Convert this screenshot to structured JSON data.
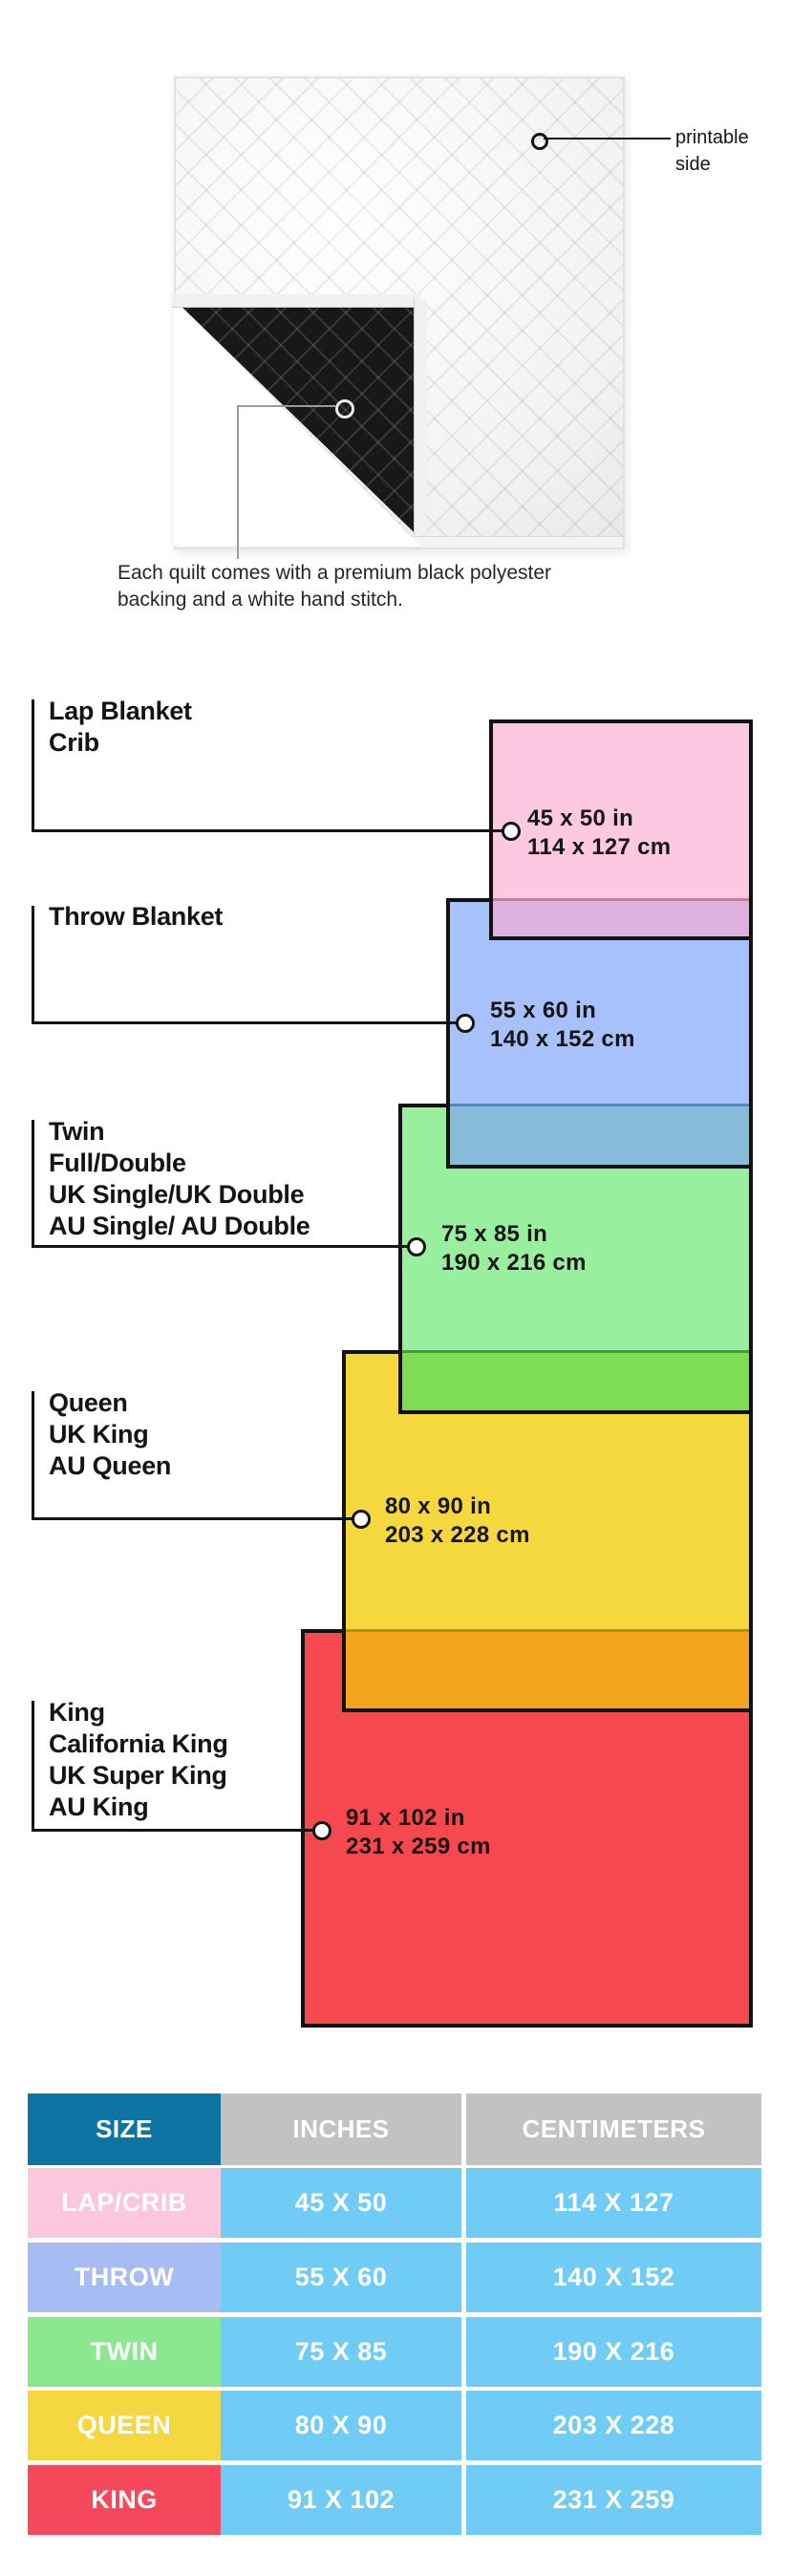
{
  "colors": {
    "page_bg": "#ffffff",
    "outline": "#121212",
    "leader_line": "#141414",
    "header_size_bg": "#0e74a4",
    "header_metric_bg": "#c2c2c2",
    "value_cell_bg": "#70cbf5"
  },
  "quilt": {
    "printable_callout": {
      "line1": "printable",
      "line2": "side"
    },
    "caption": {
      "line1": "Each quilt comes with a premium black polyester",
      "line2": "backing and a white hand stitch."
    }
  },
  "diagram": {
    "sizes": [
      {
        "id": "lap",
        "labels": [
          "Lap Blanket",
          "Crib"
        ],
        "inches": "45 x 50 in",
        "centimeters": "114 x 127 cm",
        "fill": "#fdc9e2",
        "overlap_fill": "#deb2de",
        "overlap_line": "#c2809e"
      },
      {
        "id": "throw",
        "labels": [
          "Throw Blanket"
        ],
        "inches": "55 x 60 in",
        "centimeters": "140 x 152 cm",
        "fill": "#a6c1fb",
        "overlap_fill": "#86bcd9",
        "overlap_line": "#5c84ba"
      },
      {
        "id": "twin",
        "labels": [
          "Twin",
          "Full/Double",
          "UK Single/UK Double",
          "AU Single/ AU Double"
        ],
        "inches": "75 x 85 in",
        "centimeters": "190 x 216 cm",
        "fill": "#98ef9e",
        "overlap_fill": "#7edc55",
        "overlap_line": "#3f9e41"
      },
      {
        "id": "queen",
        "labels": [
          "Queen",
          "UK King",
          "AU Queen"
        ],
        "inches": "80 x 90 in",
        "centimeters": "203 x 228 cm",
        "fill": "#f5d83e",
        "overlap_fill": "#f4a51d",
        "overlap_line": "#b08e12"
      },
      {
        "id": "king",
        "labels": [
          "King",
          "California King",
          "UK Super King",
          "AU King"
        ],
        "inches": "91 x 102 in",
        "centimeters": "231 x 259 cm",
        "fill": "#f5484f"
      }
    ]
  },
  "table": {
    "headers": {
      "size": "SIZE",
      "inches": "INCHES",
      "centimeters": "CENTIMETERS"
    },
    "rows": [
      {
        "size": "LAP/CRIB",
        "inches": "45 X 50",
        "centimeters": "114 X 127",
        "label_bg": "#fbc7de"
      },
      {
        "size": "THROW",
        "inches": "55 X 60",
        "centimeters": "140 X 152",
        "label_bg": "#a8bcf4"
      },
      {
        "size": "TWIN",
        "inches": "75 X 85",
        "centimeters": "190 X 216",
        "label_bg": "#8ae98e"
      },
      {
        "size": "QUEEN",
        "inches": "80 X 90",
        "centimeters": "203 X 228",
        "label_bg": "#f5d840"
      },
      {
        "size": "KING",
        "inches": "91 X 102",
        "centimeters": "231 X 259",
        "label_bg": "#f5485a"
      }
    ]
  }
}
